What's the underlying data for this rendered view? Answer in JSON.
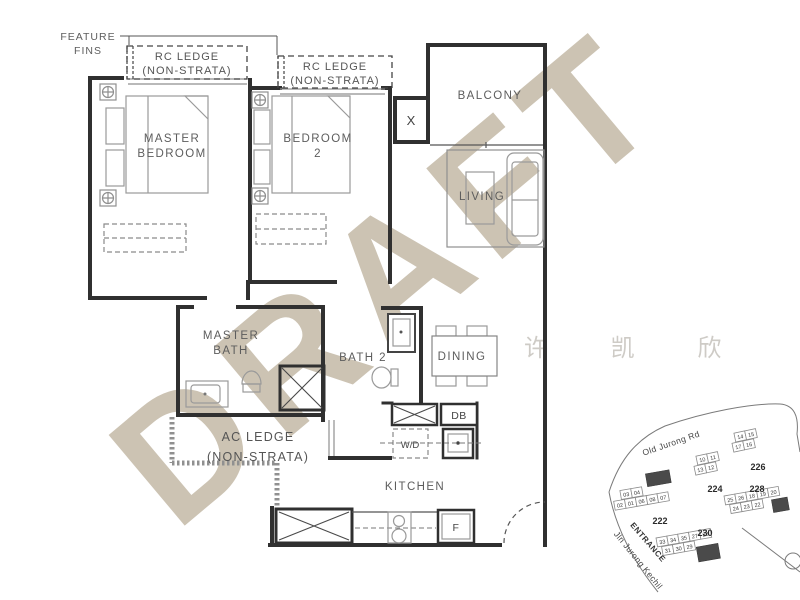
{
  "watermarks": {
    "draft": "DRAFT",
    "name_stamp": "许 凯 欣"
  },
  "plan": {
    "rooms": {
      "master_bedroom": [
        "MASTER",
        "BEDROOM"
      ],
      "bedroom2": [
        "BEDROOM",
        "2"
      ],
      "balcony": "BALCONY",
      "living": "LIVING",
      "master_bath": [
        "MASTER",
        "BATH"
      ],
      "bath2": "BATH 2",
      "dining": "DINING",
      "kitchen": "KITCHEN"
    },
    "annotations": {
      "feature_fins": [
        "FEATURE",
        "FINS"
      ],
      "rc_ledge_1": [
        "RC LEDGE",
        "(NON-STRATA)"
      ],
      "rc_ledge_2": [
        "RC LEDGE",
        "(NON-STRATA)"
      ],
      "ac_ledge": [
        "AC LEDGE",
        "(NON-STRATA)"
      ],
      "db": "DB",
      "washer_dryer": "W/D",
      "fridge": "F",
      "shaft": "X"
    }
  },
  "site_map": {
    "roads": {
      "top": "Old Jurong Rd",
      "side": "Jln Jurong Kechil"
    },
    "entrance": "ENTRANCE",
    "blocks": [
      {
        "label": "222",
        "units": [
          "03",
          "04",
          "02",
          "01",
          "06",
          "08",
          "07"
        ]
      },
      {
        "label": "224",
        "units": [
          "10",
          "11",
          "13",
          "12"
        ]
      },
      {
        "label": "226",
        "units": [
          "14",
          "15",
          "17",
          "16"
        ]
      },
      {
        "label": "228",
        "units": [
          "25",
          "26",
          "18",
          "19",
          "20",
          "24",
          "23",
          "22"
        ]
      },
      {
        "label": "230",
        "units": [
          "33",
          "34",
          "35",
          "27",
          "28",
          "31",
          "30",
          "29"
        ]
      }
    ]
  },
  "colors": {
    "draft_watermark": "#ccc3b3",
    "wall": "#303030",
    "label": "#5d5d5d"
  }
}
